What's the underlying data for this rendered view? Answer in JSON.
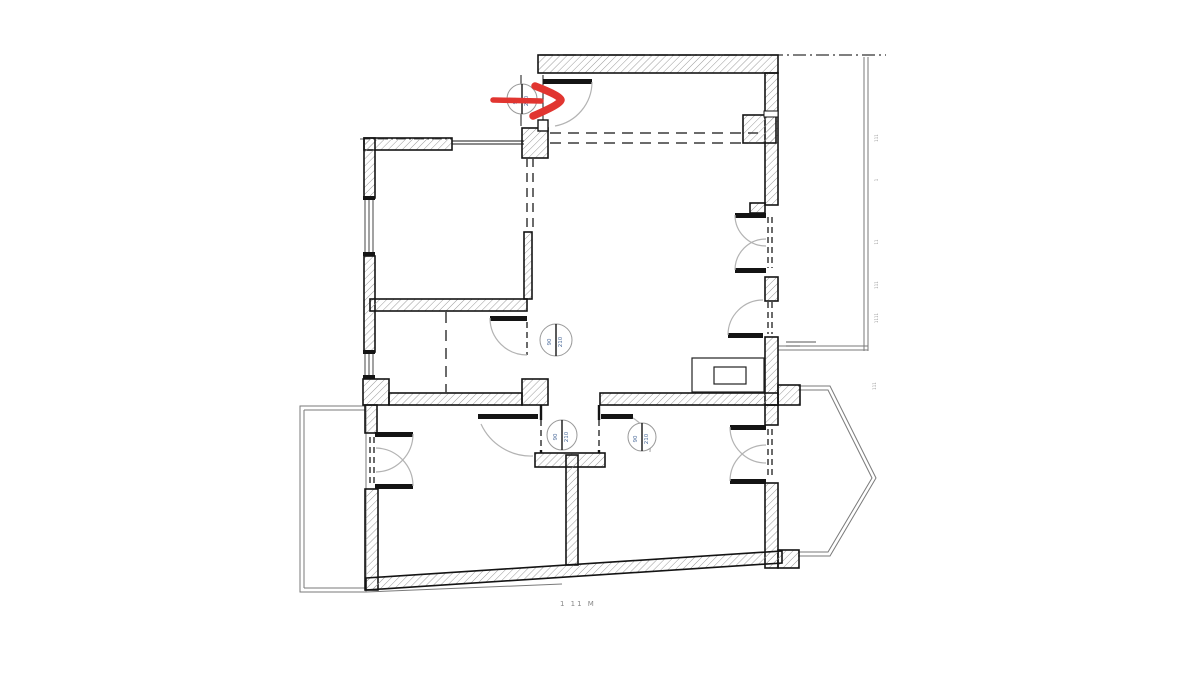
{
  "colors": {
    "arrow": "#e13530",
    "wall_line": "#141414",
    "hatch": "#9a9a9a",
    "dash": "#3a3a3a",
    "arc": "#b3b3b3",
    "thin_outline": "#7a7a7a",
    "tag_text": "#4a6a9a"
  },
  "door_tags": [
    {
      "id": "entry-door-tag",
      "left": "90",
      "right": "210"
    },
    {
      "id": "inner-room-door-tag",
      "left": "90",
      "right": "210"
    },
    {
      "id": "hall-left-door-tag",
      "left": "90",
      "right": "210"
    },
    {
      "id": "hall-right-door-tag",
      "left": "90",
      "right": "210"
    }
  ],
  "bottom_label": "1 11 M",
  "edge_annotations": {
    "a1": "111",
    "a2": "1",
    "a3": "11",
    "a4": "111",
    "a5": "1111",
    "a6": "111"
  }
}
